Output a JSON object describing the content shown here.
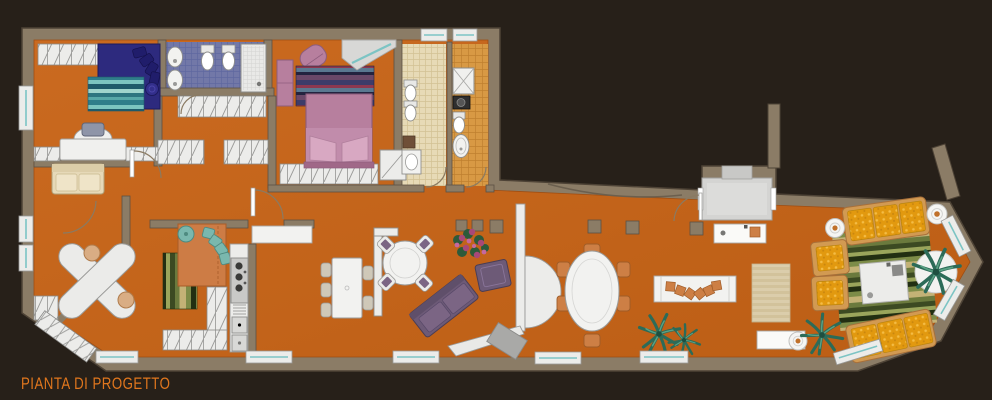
{
  "title": {
    "label": "PIANTA DI PROGETTO"
  },
  "palette": {
    "background": "#272019",
    "wall": "#8b7c66",
    "wall_edge": "#4e4336",
    "floor": "#c4661c",
    "white_furniture": "#ececea",
    "tile_blue": "#7278a8",
    "tile_beige": "#e7dab6",
    "tile_orange": "#d89944",
    "bed_blue": "#2d2a7e",
    "bed_mauve": "#b77f9e",
    "sofa_purple": "#6d5a77",
    "cushion_yellow": "#e2990f",
    "sofa_frame_tan": "#d29a52",
    "kitchen_island_orange": "#cd7c45",
    "chair_teal": "#7ab8ae",
    "window_glass": "#7cc4c4",
    "plant_green": "#2c6b58",
    "rug_teal": "#2f7d8a",
    "rug_green": "#3c4a22",
    "rug_navy": "#3c3c6a",
    "entry_gray": "#d4d4d2",
    "title_orange": "#e0761d"
  },
  "rooms": [
    "bedroom-1",
    "main-bathroom",
    "bedroom-2",
    "guest-bathroom",
    "service-bathroom",
    "study-nook",
    "studio",
    "kitchen",
    "dining-area",
    "sitting-area",
    "entrance-vestibule",
    "living-room"
  ],
  "furniture": [
    "double-bed-blue",
    "double-bed-mauve",
    "desk",
    "loveseat",
    "wardrobes",
    "shower",
    "twin-sinks",
    "toilet",
    "bidet",
    "washing-machine",
    "kitchen-island",
    "cooktop",
    "double-sink",
    "drawing-tables",
    "round-dining-table",
    "long-dining-table",
    "oval-dining-table",
    "purple-sofa",
    "ottoman",
    "yellow-sofas",
    "armchairs",
    "coffee-table",
    "bench",
    "consoles",
    "side-tables",
    "rugs",
    "palm-plants"
  ]
}
